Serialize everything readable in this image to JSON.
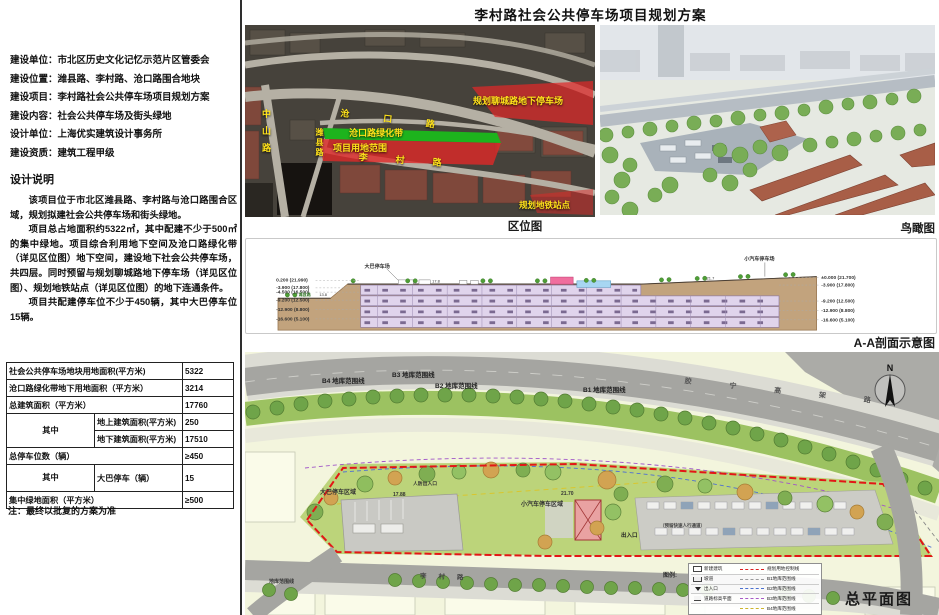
{
  "title": "李村路社会公共停车场项目规划方案",
  "info": {
    "lines": [
      "建设单位：市北区历史文化记忆示范片区管委会",
      "建设位置：潍县路、李村路、沧口路围合地块",
      "建设项目：李村路社会公共停车场项目规划方案",
      "建设内容：社会公共停车场及街头绿地",
      "设计单位：上海优实建筑设计事务所",
      "建设资质：建筑工程甲级"
    ]
  },
  "design_notes": {
    "heading": "设计说明",
    "paragraphs": [
      "该项目位于市北区潍县路、李村路与沧口路围合区域，规划拟建社会公共停车场和街头绿地。",
      "项目总占地面积约5322㎡，其中配建不少于500㎡的集中绿地。项目综合利用地下空间及沧口路绿化带（详见区位图）地下空间，建设地下社会公共停车场，共四层。同时预留与规划聊城路地下停车场（详见区位图）、规划地铁站点（详见区位图）的地下连通条件。",
      "项目共配建停车位不少于450辆，其中大巴停车位15辆。"
    ]
  },
  "spec_table": {
    "rows": [
      {
        "label": "社会公共停车场地块用地面积(平方米)",
        "value": "5322"
      },
      {
        "label": "沧口路绿化带地下用地面积（平方米）",
        "value": "3214"
      },
      {
        "label": "总建筑面积（平方米）",
        "value": "17760"
      },
      {
        "group": "其中",
        "label": "地上建筑面积(平方米)",
        "value": "250"
      },
      {
        "label": "地下建筑面积(平方米)",
        "value": "17510"
      },
      {
        "label": "总停车位数（辆）",
        "value": "≥450"
      },
      {
        "group": "其中",
        "label": "大巴停车（辆）",
        "value": "15"
      },
      {
        "label": "集中绿地面积（平方米）",
        "value": "≥500"
      }
    ],
    "note": "注：最终以批复的方案为准"
  },
  "location_map": {
    "caption": "区位图",
    "labels": {
      "planned_parking": "规划聊城路地下停车场",
      "green_belt": "沧口路绿化带",
      "site_scope": "项目用地范围",
      "metro": "规划地铁站点",
      "zhongshan_rd": "中山路",
      "weixian_rd": "潍县路",
      "cangkou_rd": "沧口路",
      "licun_rd": "李村路"
    }
  },
  "aerial_view": {
    "caption": "鸟瞰图"
  },
  "section": {
    "caption": "A-A剖面示意图",
    "left_levels": [
      "0.200 (21.990)",
      "-3.900 (17.800)",
      "-4.500 (16.500)",
      "-9.200 (12.500)",
      "-12.900 (8.800)",
      "-16.600 (5.100)"
    ],
    "right_levels": [
      "±0.000 (21.700)",
      "-3.900 (17.800)",
      "-9.200 (12.500)",
      "-12.900 (8.800)",
      "-16.600 (5.100)"
    ],
    "labels": {
      "bus": "大巴停车场",
      "car": "小汽车停车场",
      "road": "潍县路",
      "lv1": "13.8",
      "lv2": "17.8",
      "lv3": "21.7"
    }
  },
  "site_plan": {
    "caption": "总平面图",
    "north": "N",
    "b_lines": [
      "B4 地库范围线",
      "B3 地库范围线",
      "B2 地库范围线",
      "B1 地库范围线"
    ],
    "labels": {
      "bus_area": "大巴停车区域",
      "car_area": "小汽车停车区域",
      "civil_defense": "人防出入口",
      "entrance": "出入口",
      "elev_a": "17.88",
      "elev_b": "21.70",
      "garage_line": "地库范围线",
      "walkway": "（预留快速人行通道）",
      "jiaoning_rd": "胶宁高架路",
      "licun_rd": "李村路"
    },
    "legend": {
      "title": "图例:",
      "left": [
        "新建建筑",
        "坡道",
        "出入口",
        "道路标高平面"
      ],
      "right": [
        "规划用地控制线",
        "B1地库范围线",
        "B2地库范围线",
        "B3地库范围线",
        "B4地库范围线"
      ]
    }
  },
  "colors": {
    "zone_red": "#e02828",
    "belt_green": "#1db31d",
    "boundary_red": "#e31616",
    "label_yellow": "#ffe21a"
  }
}
